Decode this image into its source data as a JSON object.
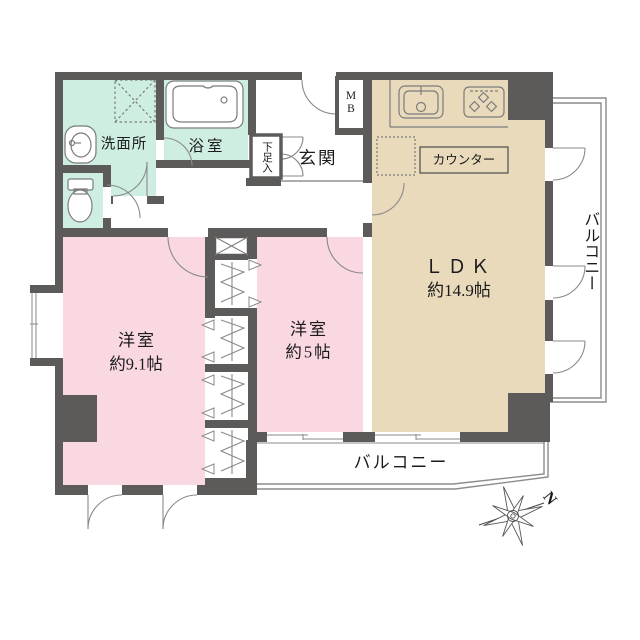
{
  "rooms": {
    "washroom": {
      "label": "洗面所"
    },
    "bathroom": {
      "label": "浴室"
    },
    "shoe_cabinet": {
      "label": "下足入"
    },
    "entrance": {
      "label": "玄関"
    },
    "meter_box": {
      "label": "M\nB"
    },
    "kitchen_counter": {
      "label": "カウンター"
    },
    "ldk": {
      "label": "ＬＤＫ",
      "size": "約14.9帖"
    },
    "bedroom_large": {
      "label": "洋室",
      "size": "約9.1帖"
    },
    "bedroom_small": {
      "label": "洋室",
      "size": "約5帖"
    },
    "balcony_side": {
      "label": "バルコニー"
    },
    "balcony_bottom": {
      "label": "バルコニー"
    }
  },
  "compass": {
    "north_label": "N"
  },
  "colors": {
    "wall": "#5d5a5a",
    "wet_area_fill": "#cdeee1",
    "bedroom_fill": "#f9d8e2",
    "ldk_fill": "#e9dabc",
    "fixture_line": "#7c7c7c",
    "balcony_line": "#8c8c8c"
  }
}
